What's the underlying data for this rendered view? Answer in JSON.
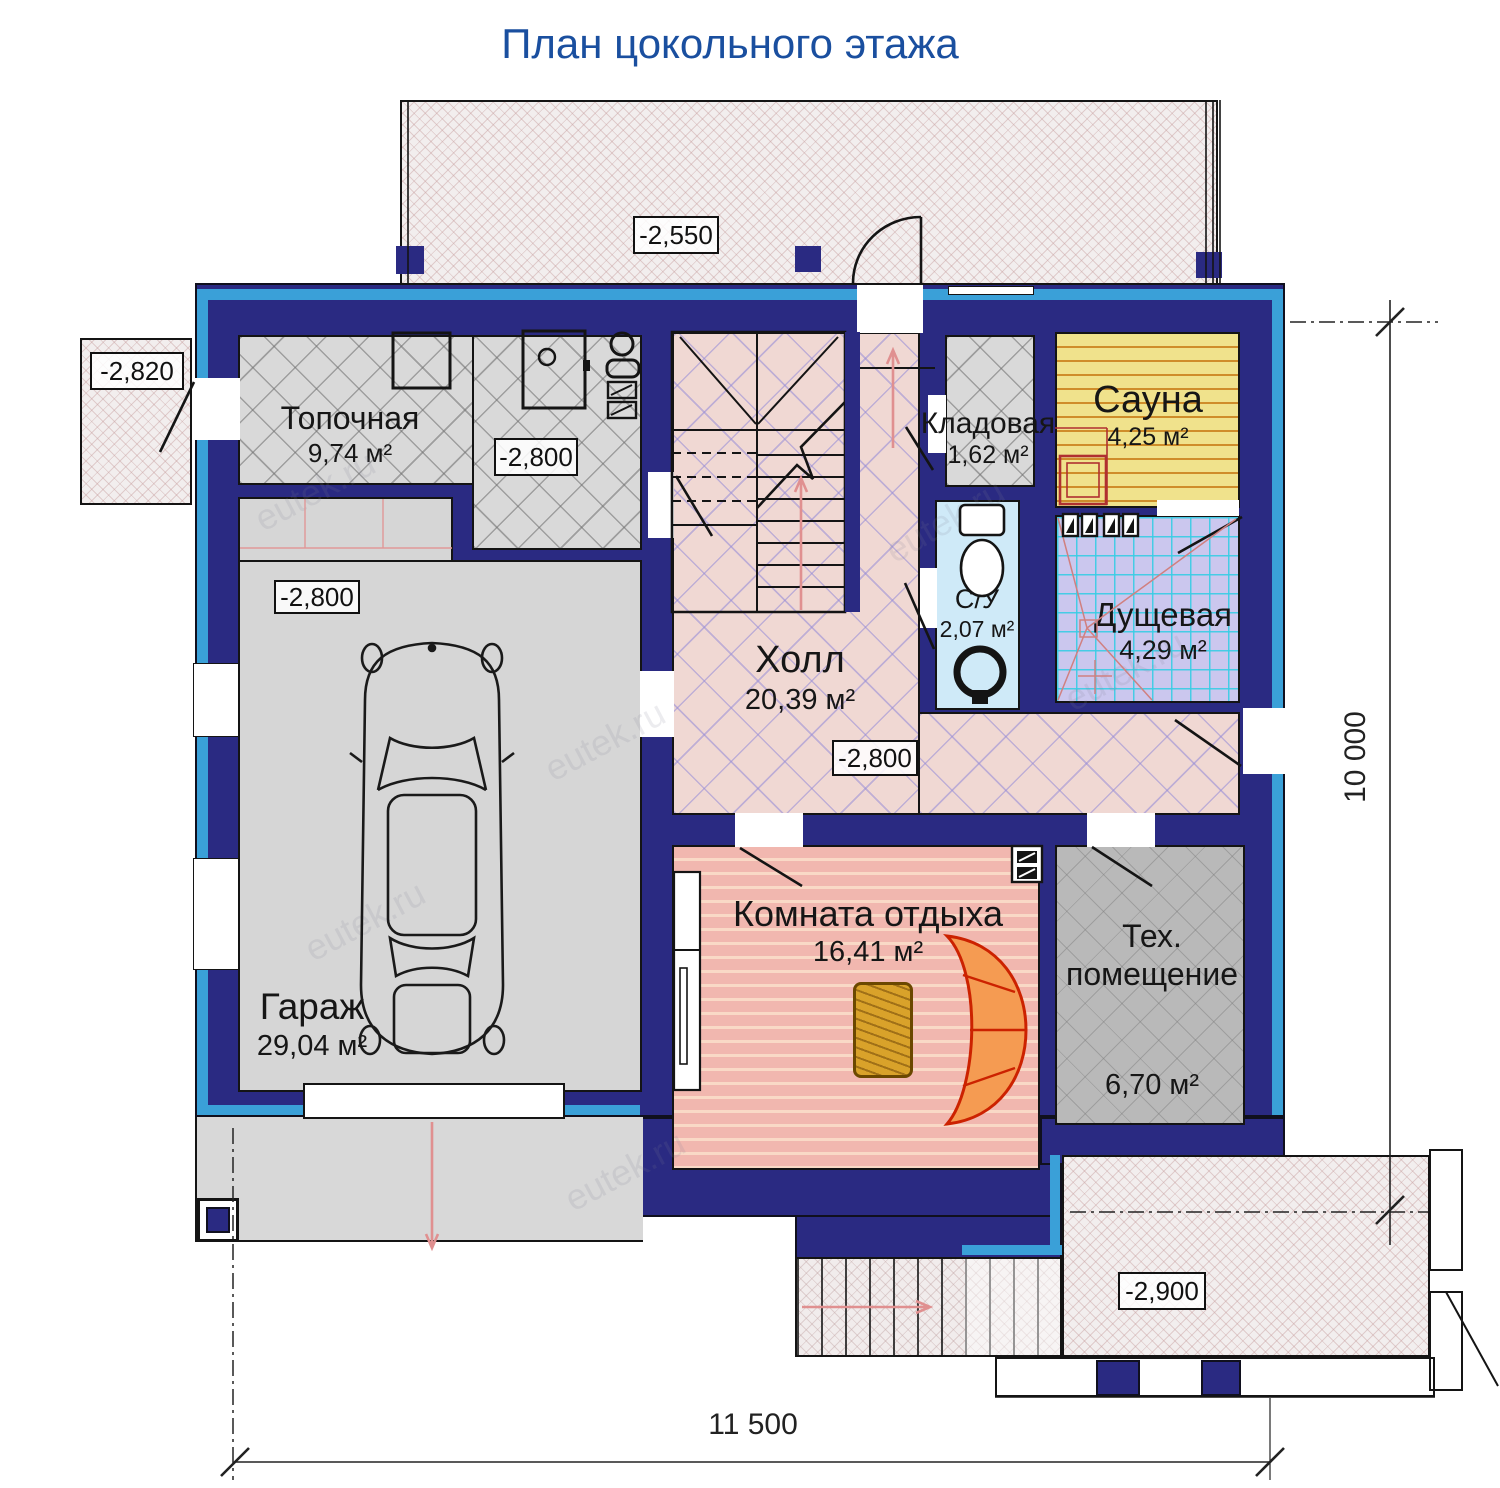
{
  "title": "План цокольного этажа",
  "watermark": "eutek.ru",
  "colors": {
    "wall": "#2a2a82",
    "trim": "#3aa0d8",
    "title": "#1a4f9f",
    "sauna_floor": "#f0e28c",
    "shower_floor": "#cbc7ee",
    "wc_floor": "#cfeaf8",
    "hall_floor": "#f0d8d3",
    "rest_floor": "#f1b7af",
    "sofa": "#f59b52",
    "table": "#d9a22a"
  },
  "rooms": {
    "topochnaya": {
      "name": "Топочная",
      "area": "9,74 м²"
    },
    "garage": {
      "name": "Гараж",
      "area": "29,04 м²"
    },
    "hall": {
      "name": "Холл",
      "area": "20,39 м²"
    },
    "kladovaya": {
      "name": "Кладовая",
      "area": "1,62 м²"
    },
    "sauna": {
      "name": "Сауна",
      "area": "4,25 м²"
    },
    "su": {
      "name": "С/У",
      "area": "2,07 м²"
    },
    "dushevaya": {
      "name": "Дущевая",
      "area": "4,29 м²"
    },
    "rest": {
      "name": "Комната отдыха",
      "area": "16,41 м²"
    },
    "tech": {
      "name_line1": "Тех.",
      "name_line2": "помещение",
      "area": "6,70 м²"
    }
  },
  "elevations": {
    "terrace_top": "-2,550",
    "porch_left": "-2,820",
    "topochnaya": "-2,800",
    "garage": "-2,800",
    "hall": "-2,800",
    "entry": "-2,900"
  },
  "dimensions": {
    "height": "10 000",
    "width": "11 500"
  }
}
